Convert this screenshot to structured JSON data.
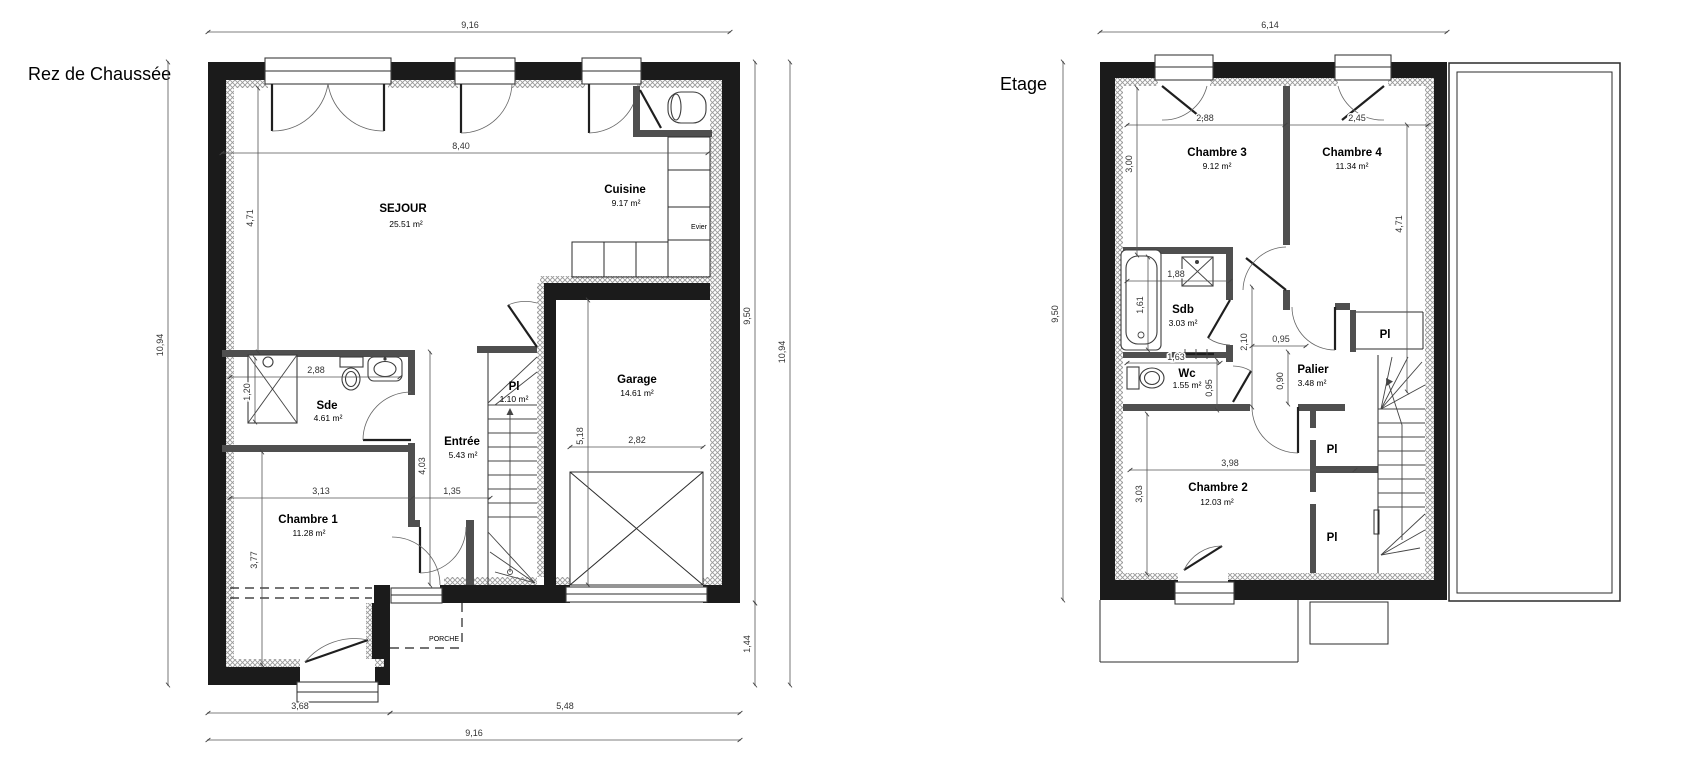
{
  "colors": {
    "background": "#ffffff",
    "wall": "#1b1b1b",
    "partition": "#4f4f4f",
    "hatch": "#9a9a9a",
    "dimension": "#555555",
    "text": "#000000"
  },
  "rdc": {
    "title": "Rez de Chaussée",
    "rooms": {
      "sejour": {
        "name": "SEJOUR",
        "area": "25.51 m²"
      },
      "cuisine": {
        "name": "Cuisine",
        "area": "9.17 m²"
      },
      "evier": {
        "name": "Evier"
      },
      "sde": {
        "name": "Sde",
        "area": "4.61 m²"
      },
      "entree": {
        "name": "Entrée",
        "area": "5.43 m²"
      },
      "placard": {
        "name": "Pl",
        "area": "1.10 m²"
      },
      "garage": {
        "name": "Garage",
        "area": "14.61 m²"
      },
      "chambre1": {
        "name": "Chambre 1",
        "area": "11.28 m²"
      },
      "porche": {
        "name": "PORCHE"
      }
    },
    "dims": {
      "top_total": "9,16",
      "sejour_w": "8,40",
      "left_total": "10,94",
      "sejour_h": "4,71",
      "sde_w": "2,88",
      "shower_h": "1,20",
      "hall_h": "4,03",
      "chambre1_w": "3,13",
      "hall_w": "1,35",
      "chambre1_h": "3,77",
      "garage_h": "5,18",
      "garage_door_w": "2,82",
      "right_main": "9,50",
      "right_lower": "1,44",
      "right_total": "10,94",
      "bottom_left": "3,68",
      "bottom_right": "5,48",
      "bottom_total": "9,16"
    }
  },
  "etage": {
    "title": "Etage",
    "rooms": {
      "chambre3": {
        "name": "Chambre 3",
        "area": "9.12 m²"
      },
      "chambre4": {
        "name": "Chambre 4",
        "area": "11.34 m²"
      },
      "sdb": {
        "name": "Sdb",
        "area": "3.03 m²"
      },
      "wc": {
        "name": "Wc",
        "area": "1.55 m²"
      },
      "palier": {
        "name": "Palier",
        "area": "3.48 m²"
      },
      "chambre2": {
        "name": "Chambre 2",
        "area": "12.03 m²"
      },
      "pl_haut": {
        "name": "Pl"
      },
      "pl_milieu": {
        "name": "Pl"
      },
      "pl_bas": {
        "name": "Pl"
      }
    },
    "dims": {
      "top_total": "6,14",
      "left_total": "9,50",
      "chambre3_w": "2,88",
      "chambre4_w": "2,45",
      "chambre3_h": "3,00",
      "chambre4_h": "4,71",
      "bain_w": "1,88",
      "bain_l": "1,61",
      "wc_w": "1,63",
      "degagement_h": "2,10",
      "degagement_w": "0,95",
      "wc_h": "0,95",
      "palier_h": "0,90",
      "chambre2_w": "3,98",
      "chambre2_h": "3,03"
    }
  }
}
